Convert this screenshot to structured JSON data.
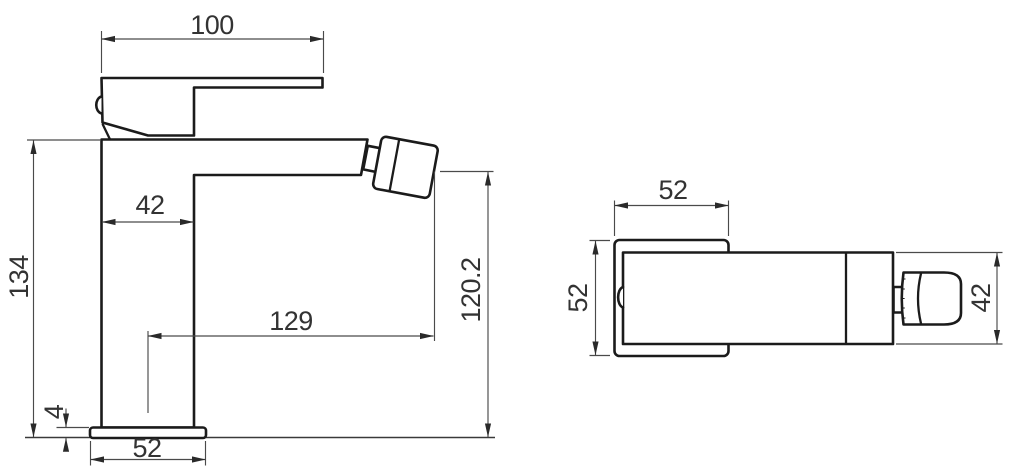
{
  "drawing": {
    "description": "Technical dimension drawing of a single-lever bidet mixer tap, side view and top view",
    "units_shown": false
  },
  "dims": {
    "side": {
      "handle_width": "100",
      "body_depth": "42",
      "total_height": "134",
      "spout_reach": "129",
      "spout_height": "120.2",
      "base_height": "4",
      "base_width": "52"
    },
    "top": {
      "body_width": "52",
      "body_depth": "52",
      "spout_width": "42"
    }
  },
  "colors": {
    "background": "#ffffff",
    "outline": "#1b1b1b",
    "dimension_lines": "#4a4a4a",
    "text": "#333333"
  }
}
